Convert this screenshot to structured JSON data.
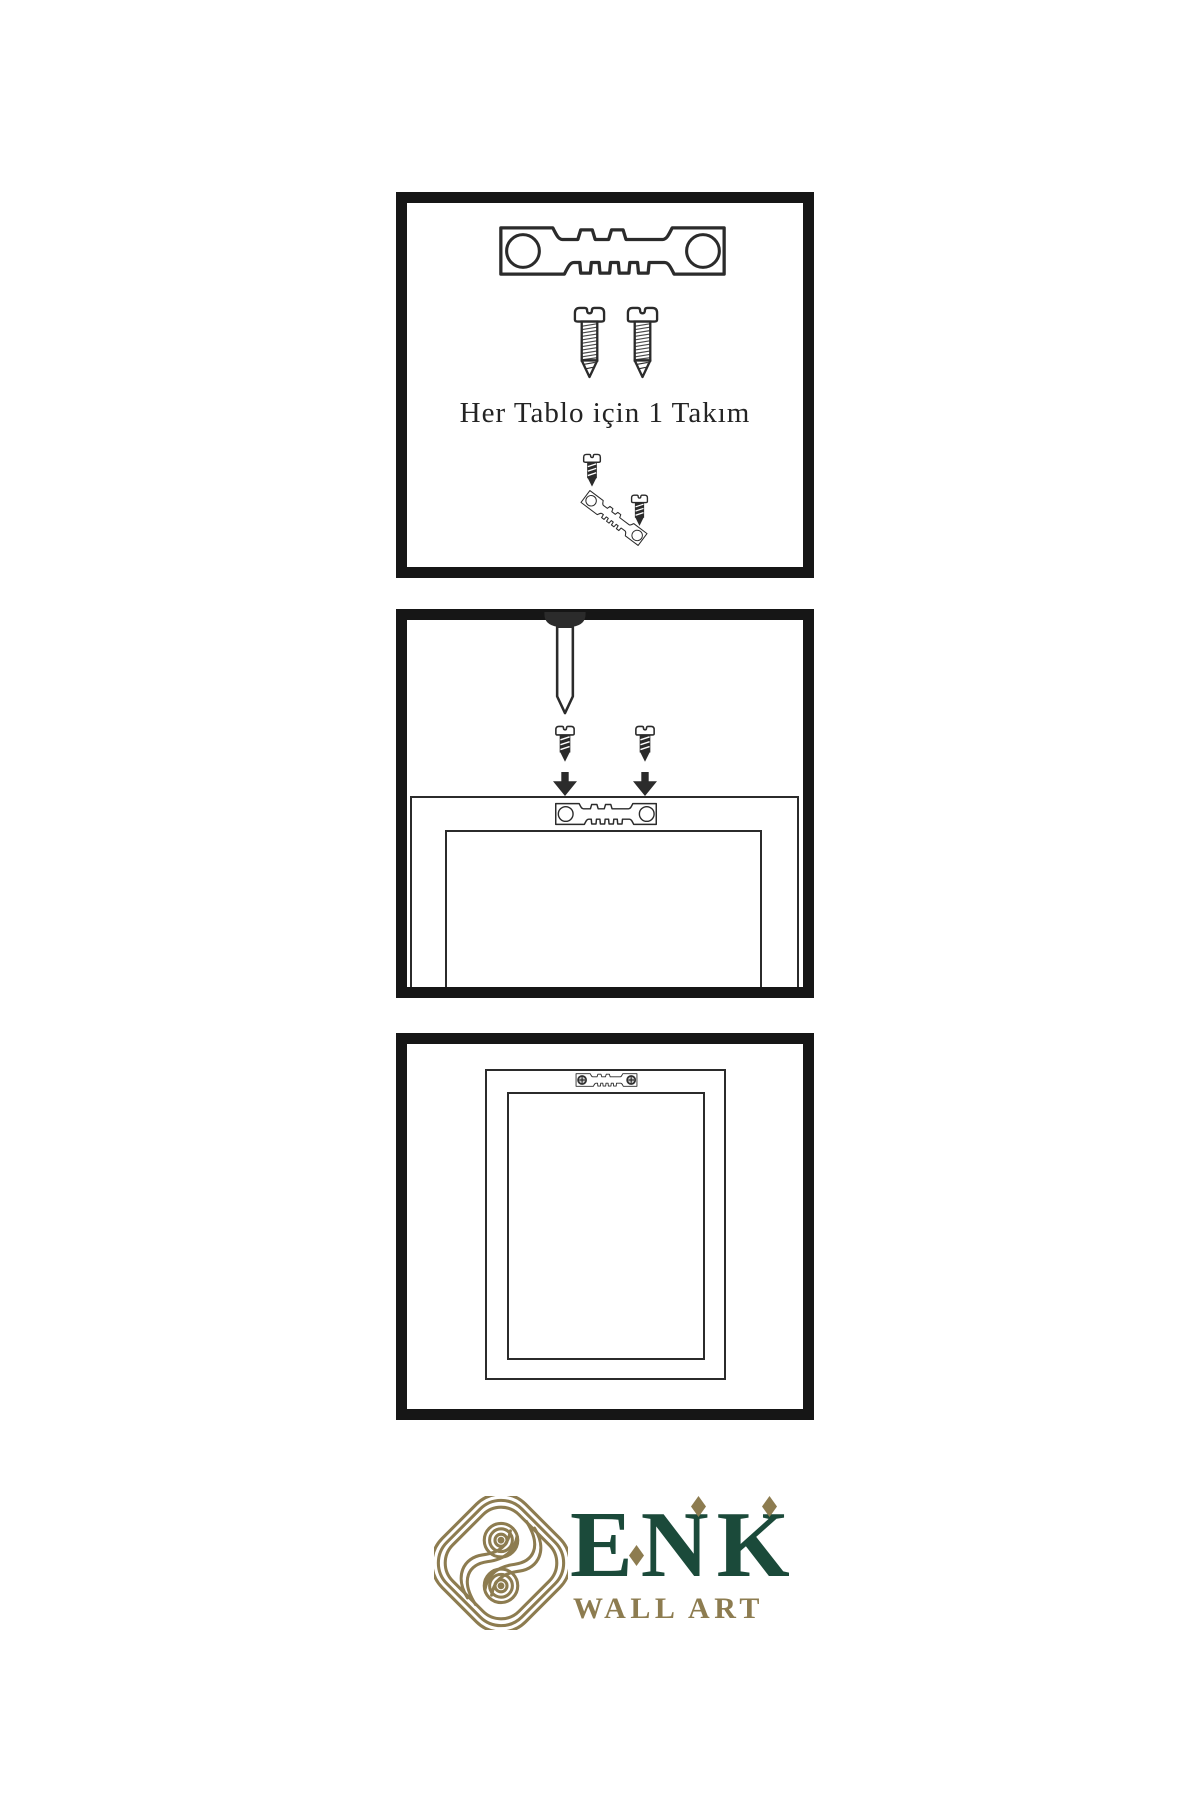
{
  "colors": {
    "paper": "#ffffff",
    "ink": "#2b2b2b",
    "panel_border": "#161616",
    "green": "#1b4a3a",
    "gold": "#8d7c50"
  },
  "steps": [
    {
      "id": 1,
      "caption": "Her Tablo için 1 Takım"
    },
    {
      "id": 2,
      "caption": ""
    },
    {
      "id": 3,
      "caption": ""
    }
  ],
  "logo": {
    "brand": "ENK",
    "tagline": "WALL ART"
  },
  "icons": {
    "sawtooth_hanger": "castellated metal bar with two screw holes",
    "screw": "side-view wood screw with notched pan head",
    "dark_screw": "short dark screw",
    "nail": "wall nail pointing down",
    "arrow_down": "solid black down arrow",
    "picture_frame": "nested rectangles",
    "knot_logo": "interlaced gold knot medallion",
    "diamond_accent": "gold rhombus"
  }
}
